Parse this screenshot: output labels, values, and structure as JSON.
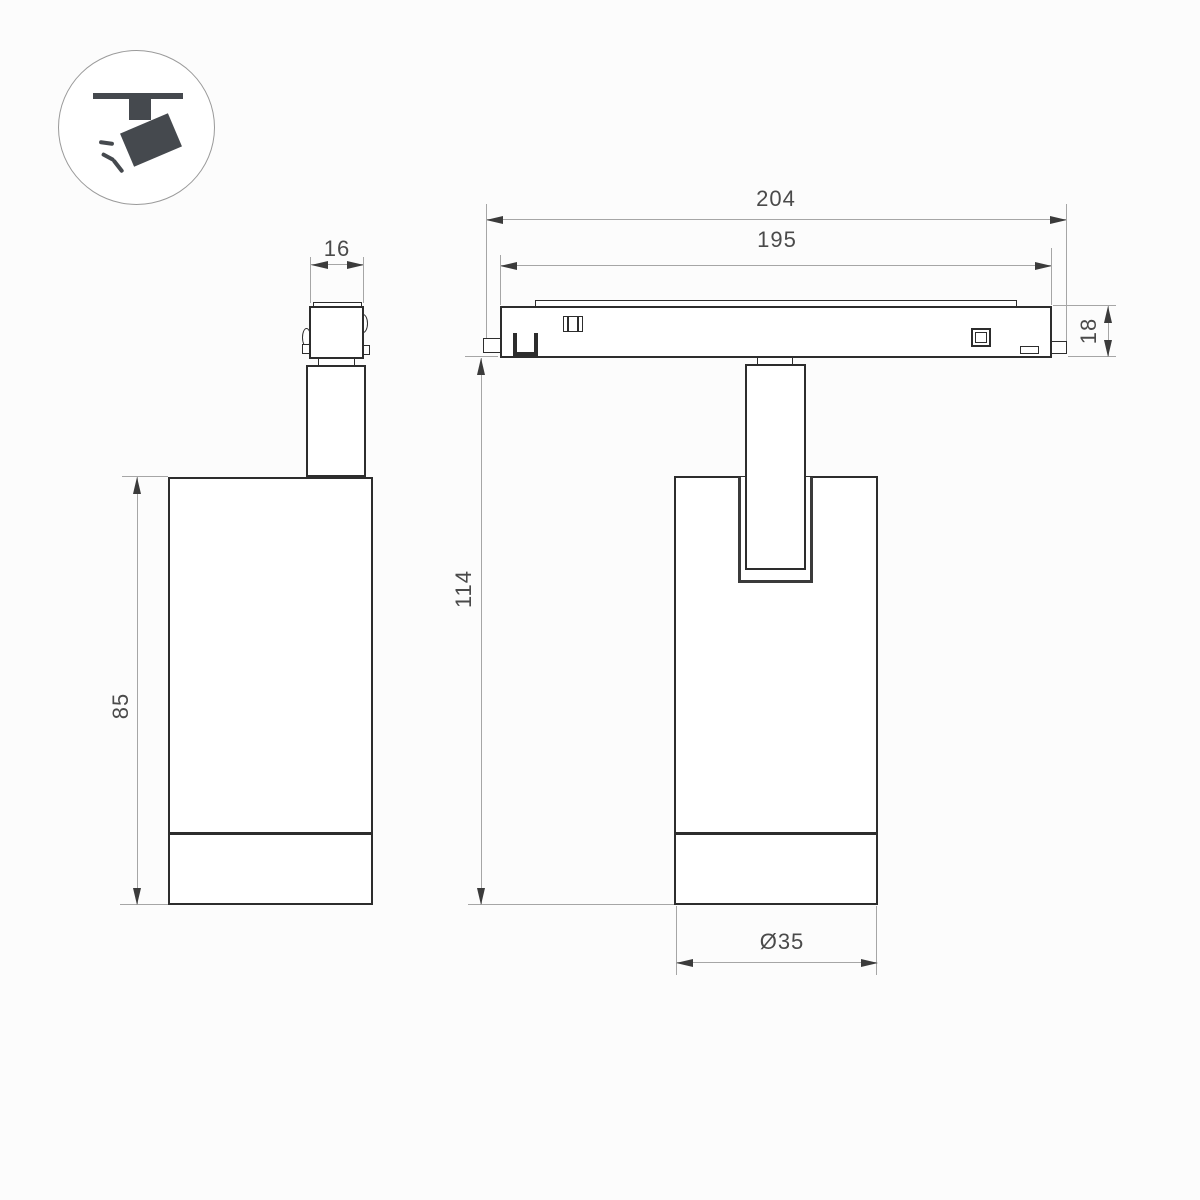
{
  "icon": {
    "name": "track-spotlight"
  },
  "dims": {
    "adapter_width": "16",
    "track_overall_length": "204",
    "track_inner_length": "195",
    "track_height": "18",
    "body_height": "85",
    "total_height": "114",
    "body_diameter": "Ø35"
  },
  "colors": {
    "outline": "#2d2d2d",
    "dimension_line": "#a6a6a6",
    "dimension_text": "#4a4a4a",
    "icon_fill": "#45494e",
    "background": "#fcfcfc"
  }
}
